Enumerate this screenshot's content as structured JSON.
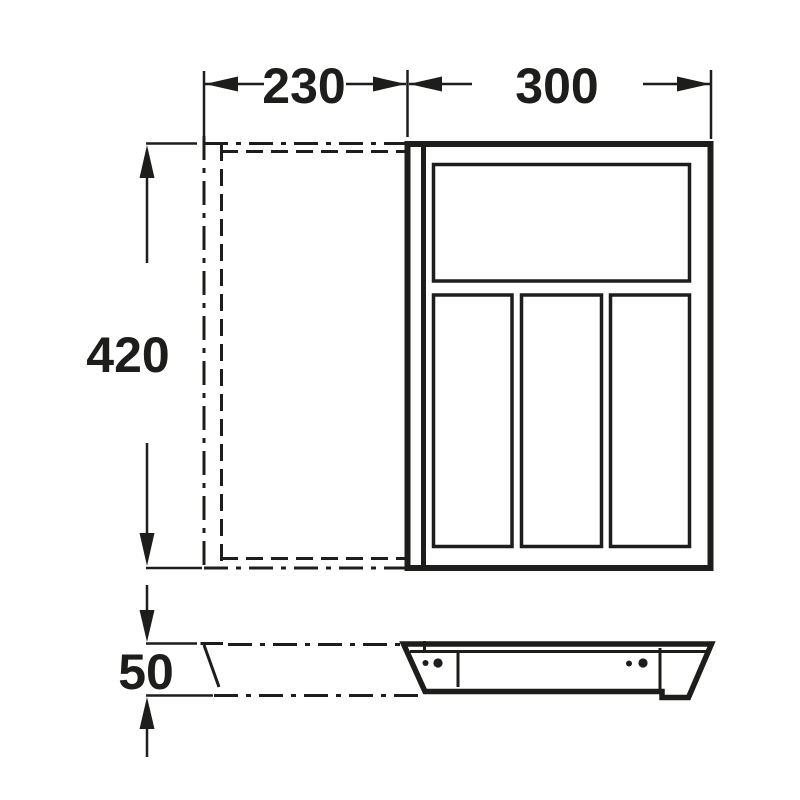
{
  "colors": {
    "line": "#1d1d1b",
    "background": "#ffffff"
  },
  "dimensions": {
    "extension_width": {
      "value": "230"
    },
    "tray_width": {
      "value": "300"
    },
    "tray_depth": {
      "value": "420"
    },
    "tray_height": {
      "value": "50"
    }
  }
}
